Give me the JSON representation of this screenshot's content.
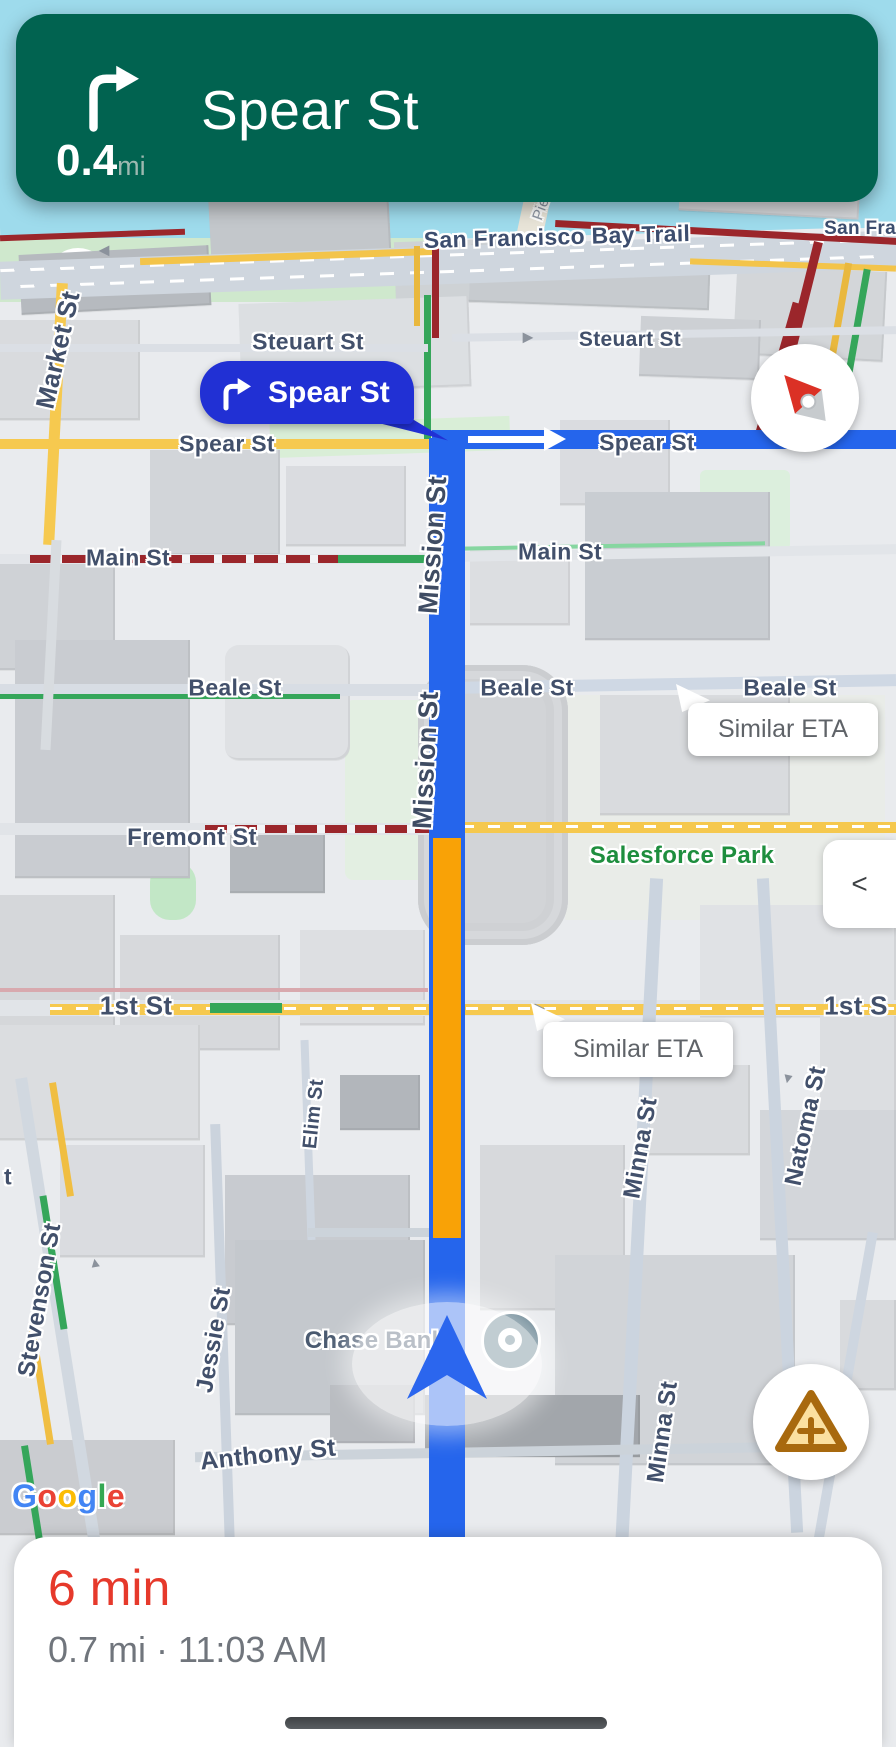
{
  "banner": {
    "distance": "0.4",
    "unit": "mi",
    "street": "Spear St"
  },
  "callout": {
    "street": "Spear St"
  },
  "map": {
    "labels": {
      "bay_trail": "San Francisco Bay Trail",
      "bay_trail_right": "San Fran",
      "pier": "Pie",
      "market": "Market St",
      "steuart_left": "Steuart St",
      "steuart_right": "Steuart St",
      "spear_left": "Spear St",
      "spear_right": "Spear St",
      "main_left": "Main St",
      "main_right": "Main St",
      "beale_left": "Beale St",
      "beale_mid": "Beale St",
      "beale_right": "Beale St",
      "fremont": "Fremont St",
      "first_left": "1st St",
      "first_right": "1st S",
      "mission_a": "Mission St",
      "mission_b": "Mission St",
      "minna_a": "Minna St",
      "minna_b": "Minna St",
      "natoma": "Natoma St",
      "elim": "Elim St",
      "jessie": "Jessie St",
      "stevenson": "Stevenson St",
      "stevenson_partial": "t",
      "howard_partial": "d St",
      "anthony": "Anthony St",
      "chase": "Chase Bank",
      "salesforce_park": "Salesforce Park"
    },
    "eta_bubble_1": "Similar ETA",
    "eta_bubble_2": "Similar ETA",
    "collapse_button": "<",
    "google": [
      "G",
      "o",
      "o",
      "g",
      "l",
      "e"
    ],
    "google_colors": [
      "#4285F4",
      "#EA4335",
      "#FBBC05",
      "#4285F4",
      "#34A853",
      "#EA4335"
    ]
  },
  "sheet": {
    "eta": "6 min",
    "details": "0.7 mi · 11:03 AM"
  },
  "colors": {
    "banner_green": "#016350",
    "route_blue": "#2565ec",
    "traffic_orange": "#f9a206",
    "traffic_dark_red": "#9b262b",
    "road_yellow": "#f6c94f",
    "transit_green": "#35a65a",
    "water": "#9edbec",
    "callout_blue": "#2130d4",
    "eta_red": "#e6392b"
  }
}
